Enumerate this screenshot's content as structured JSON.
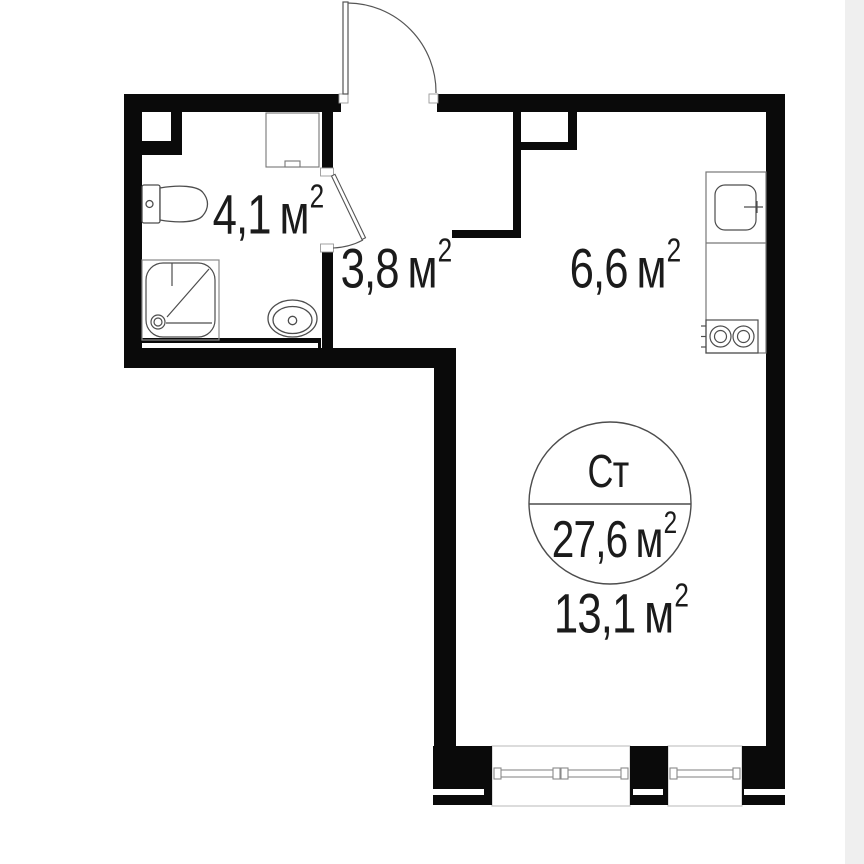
{
  "plan": {
    "type": "studio-apartment-floor-plan",
    "stamp": {
      "type_label": "Ст",
      "total_area": "27,6",
      "unit": "м",
      "sup": "2"
    },
    "rooms": [
      {
        "name": "bathroom",
        "area": "4,1",
        "unit": "м",
        "sup": "2"
      },
      {
        "name": "hallway",
        "area": "3,8",
        "unit": "м",
        "sup": "2"
      },
      {
        "name": "kitchen",
        "area": "6,6",
        "unit": "м",
        "sup": "2"
      },
      {
        "name": "main-room",
        "area": "13,1",
        "unit": "м",
        "sup": "2"
      }
    ]
  },
  "colors": {
    "wall": "#0a0a0a",
    "fixture_line": "#4d4d4d",
    "window_line": "#8a8a8a",
    "reveal_line": "#c4c4c4",
    "text": "#1b1b1b",
    "background": "#ffffff",
    "right_margin_strip": "#efefef"
  },
  "icons": {
    "entrance-door-icon": "quarter-arc swing + leaf line",
    "bathroom-door-icon": "angled leaf + small swing arc",
    "toilet-icon": "tank rectangle + bowl outline",
    "shower-icon": "rounded square tray + diagonal + corner drain",
    "bathroom-sink-icon": "double oval basin + drain",
    "washing-machine-icon": "plain rectangle with bottom notch",
    "kitchen-sink-icon": "rounded square + faucet tick",
    "stove-icon": "rectangle with two burner circles",
    "window-icon": "double line in wall opening",
    "vent-shaft-icon": "small white niche in wall"
  }
}
